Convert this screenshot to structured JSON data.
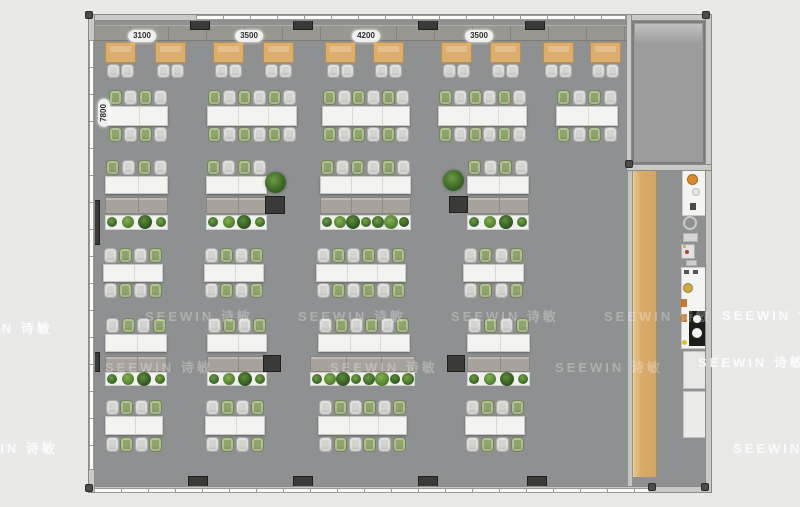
{
  "watermark": {
    "text": "SEEWIN 诗敏"
  },
  "dimension_labels": {
    "top": [
      {
        "text": "3100",
        "cx": 142,
        "cy": 36
      },
      {
        "text": "3500",
        "cx": 249,
        "cy": 36
      },
      {
        "text": "4200",
        "cx": 366,
        "cy": 36
      },
      {
        "text": "3500",
        "cx": 479,
        "cy": 36
      }
    ],
    "left": {
      "text": "7800",
      "cx": 104,
      "cy": 113
    }
  },
  "colors": {
    "background": "#e9e9e8",
    "floor": "#8f9091",
    "wood": "#d9ab6b",
    "table_white": "#f3f3f1",
    "chair_gray": "#d3d3d0",
    "chair_green": "#8ea46a",
    "credenza": "#a7a39c",
    "pillar": "#3a3a38",
    "accent_orange": "#d98a2b"
  },
  "plan": {
    "floor": {
      "x": 93,
      "y": 20,
      "w": 614,
      "h": 467
    },
    "walls": [
      {
        "name": "wall-top",
        "x": 88,
        "y": 14,
        "w": 624,
        "h": 7
      },
      {
        "name": "wall-bottom",
        "x": 88,
        "y": 486,
        "w": 624,
        "h": 7
      },
      {
        "name": "wall-left",
        "x": 88,
        "y": 14,
        "w": 7,
        "h": 479
      },
      {
        "name": "wall-right",
        "x": 705,
        "y": 14,
        "w": 7,
        "h": 479
      },
      {
        "name": "meeting-room-wall-left",
        "x": 626,
        "y": 14,
        "w": 6,
        "h": 157
      },
      {
        "name": "meeting-room-wall-bottom",
        "x": 626,
        "y": 164,
        "w": 86,
        "h": 7
      }
    ],
    "windows": [
      {
        "name": "window-strip-top",
        "dir": "h",
        "x": 196,
        "y": 15,
        "w": 430,
        "h": 5
      },
      {
        "name": "window-strip-bottom",
        "dir": "h",
        "x": 94,
        "y": 488,
        "w": 556,
        "h": 5
      },
      {
        "name": "window-strip-left",
        "dir": "v",
        "x": 89,
        "y": 40,
        "w": 5,
        "h": 430
      }
    ],
    "cabinet_band": {
      "x": 93,
      "y": 25,
      "w": 535,
      "h": 16
    },
    "meeting_room_floor": {
      "x": 632,
      "y": 21,
      "w": 73,
      "h": 143
    },
    "corridor_divider": {
      "x": 628,
      "y": 168,
      "w": 4,
      "h": 318
    },
    "wood_strip": {
      "x": 633,
      "y": 171,
      "w": 24,
      "h": 306
    },
    "pillars": [
      [
        190,
        14,
        20,
        16
      ],
      [
        293,
        14,
        20,
        16
      ],
      [
        418,
        14,
        20,
        16
      ],
      [
        525,
        14,
        20,
        16
      ],
      [
        188,
        476,
        20,
        16
      ],
      [
        293,
        476,
        20,
        16
      ],
      [
        418,
        476,
        20,
        16
      ],
      [
        527,
        476,
        20,
        16
      ],
      [
        265,
        196,
        20,
        18
      ],
      [
        449,
        196,
        19,
        17
      ],
      [
        263,
        355,
        18,
        17
      ],
      [
        447,
        355,
        18,
        17
      ],
      [
        93,
        200,
        7,
        45
      ],
      [
        93,
        352,
        7,
        20
      ]
    ],
    "corner_dots": [
      [
        85,
        11
      ],
      [
        702,
        11
      ],
      [
        85,
        484
      ],
      [
        648,
        483
      ],
      [
        701,
        483
      ],
      [
        625,
        160
      ]
    ],
    "big_plants": [
      [
        265,
        172
      ],
      [
        443,
        170
      ]
    ],
    "rows": [
      {
        "name": "window-desk-row",
        "type": "desks",
        "y": 42,
        "deskW": 31,
        "deskH": 21,
        "chairY": 64,
        "xs": [
          105,
          155,
          213,
          263,
          325,
          373,
          441,
          490,
          543,
          590
        ]
      },
      {
        "name": "bench-row-a",
        "type": "double",
        "chairTopY": 90,
        "tableY": 106,
        "tableH": 20,
        "chairBottomY": 127,
        "startGreen": true,
        "tables": [
          {
            "x": 108,
            "w": 60,
            "seats": 4
          },
          {
            "x": 207,
            "w": 90,
            "seats": 6
          },
          {
            "x": 322,
            "w": 88,
            "seats": 6
          },
          {
            "x": 438,
            "w": 89,
            "seats": 6
          },
          {
            "x": 556,
            "w": 62,
            "seats": 4
          }
        ]
      },
      {
        "name": "planter-row-a",
        "type": "planter",
        "chairTopY": 160,
        "tableY": 176,
        "tableH": 18,
        "credY": 197,
        "credH": 17,
        "plantY": 215,
        "plantH": 15,
        "startGreen": true,
        "groups": [
          {
            "x": 105,
            "w": 63,
            "seats": 4,
            "plants": 4
          },
          {
            "x": 206,
            "w": 61,
            "seats": 4,
            "plants": 4
          },
          {
            "x": 320,
            "w": 91,
            "seats": 6,
            "plants": 7
          },
          {
            "x": 467,
            "w": 62,
            "seats": 4,
            "plants": 4
          }
        ]
      },
      {
        "name": "bench-row-b",
        "type": "double",
        "chairTopY": 248,
        "tableY": 264,
        "tableH": 18,
        "chairBottomY": 283,
        "startGreen": false,
        "tables": [
          {
            "x": 103,
            "w": 60,
            "seats": 4
          },
          {
            "x": 204,
            "w": 60,
            "seats": 4
          },
          {
            "x": 316,
            "w": 90,
            "seats": 6
          },
          {
            "x": 463,
            "w": 61,
            "seats": 4
          }
        ]
      },
      {
        "name": "planter-row-b",
        "type": "planter",
        "chairTopY": 318,
        "tableY": 334,
        "tableH": 18,
        "credY": 356,
        "credH": 16,
        "plantY": 372,
        "plantH": 14,
        "startGreen": false,
        "groups": [
          {
            "x": 105,
            "w": 62,
            "seats": 4,
            "plants": 4
          },
          {
            "x": 207,
            "w": 60,
            "seats": 4,
            "plants": 4
          },
          {
            "x": 318,
            "w": 92,
            "seats": 6,
            "plants": 8,
            "credX": 310,
            "credW": 105
          },
          {
            "x": 467,
            "w": 63,
            "seats": 4,
            "plants": 4
          }
        ]
      },
      {
        "name": "bench-row-c",
        "type": "double",
        "chairTopY": 400,
        "tableY": 416,
        "tableH": 19,
        "chairBottomY": 437,
        "startGreen": false,
        "tables": [
          {
            "x": 105,
            "w": 58,
            "seats": 4
          },
          {
            "x": 205,
            "w": 60,
            "seats": 4
          },
          {
            "x": 318,
            "w": 89,
            "seats": 6
          },
          {
            "x": 465,
            "w": 60,
            "seats": 4
          }
        ]
      }
    ],
    "pantry_items": [
      {
        "t": "rect",
        "x": 682,
        "y": 170,
        "w": 25,
        "h": 46,
        "c": "#f4f4f2",
        "b": "#c9c9c7",
        "name": "pantry-counter"
      },
      {
        "t": "circ",
        "x": 687,
        "y": 174,
        "d": 11,
        "c": "#d98a2b",
        "b": "#a5641c",
        "name": "stove-burner"
      },
      {
        "t": "circ",
        "x": 692,
        "y": 188,
        "d": 8,
        "c": "#e9e9e7",
        "b": "#bbbbb9",
        "name": "sink-basin"
      },
      {
        "t": "rect",
        "x": 690,
        "y": 203,
        "w": 6,
        "h": 7,
        "c": "#4a4a48",
        "name": "fixture-glyph"
      },
      {
        "t": "ring",
        "x": 683,
        "y": 216,
        "d": 14,
        "name": "floor-fixture-ring"
      },
      {
        "t": "rect",
        "x": 683,
        "y": 233,
        "w": 15,
        "h": 9,
        "c": "#d6d6d4",
        "b": "#b5b5b3",
        "name": "floor-fixture"
      },
      {
        "t": "rect",
        "x": 681,
        "y": 244,
        "w": 14,
        "h": 15,
        "c": "#e2e2e0",
        "b": "#b0b0ae",
        "name": "appliance-panel"
      },
      {
        "t": "circ",
        "x": 685,
        "y": 250,
        "d": 4,
        "c": "#b5402f",
        "name": "panel-dot-red"
      },
      {
        "t": "circ",
        "x": 683,
        "y": 245,
        "d": 3,
        "c": "#c9a84c",
        "name": "panel-dot-gold"
      },
      {
        "t": "rect",
        "x": 686,
        "y": 260,
        "w": 11,
        "h": 6,
        "c": "#cfcfcd",
        "b": "#b0b0ae",
        "name": "floor-fixture-small"
      },
      {
        "t": "rect",
        "x": 681,
        "y": 267,
        "w": 26,
        "h": 82,
        "c": "#f4f4f2",
        "b": "#c9c9c7",
        "name": "pantry-counter"
      },
      {
        "t": "rect",
        "x": 684,
        "y": 270,
        "w": 5,
        "h": 4,
        "c": "#55554f",
        "name": "counter-glyph"
      },
      {
        "t": "rect",
        "x": 693,
        "y": 270,
        "w": 5,
        "h": 4,
        "c": "#55554f",
        "name": "counter-glyph"
      },
      {
        "t": "circ",
        "x": 683,
        "y": 283,
        "d": 10,
        "c": "#c9a84c",
        "b": "#9a7c2e",
        "name": "sink-round"
      },
      {
        "t": "rect",
        "x": 681,
        "y": 299,
        "w": 6,
        "h": 8,
        "c": "#c87830",
        "name": "counter-item-orange"
      },
      {
        "t": "rect",
        "x": 681,
        "y": 314,
        "w": 6,
        "h": 8,
        "c": "#c87830",
        "name": "counter-item-orange"
      },
      {
        "t": "rect",
        "x": 689,
        "y": 311,
        "w": 18,
        "h": 35,
        "c": "#1d1d1b",
        "name": "fridge"
      },
      {
        "t": "circ",
        "x": 693,
        "y": 315,
        "d": 8,
        "c": "#f2f2f0",
        "name": "fridge-dial"
      },
      {
        "t": "circ",
        "x": 692,
        "y": 328,
        "d": 10,
        "c": "#f2f2f0",
        "name": "fridge-dial"
      },
      {
        "t": "circ",
        "x": 682,
        "y": 340,
        "d": 5,
        "c": "#ddbf2e",
        "name": "counter-dot-yellow"
      },
      {
        "t": "rect",
        "x": 683,
        "y": 351,
        "w": 24,
        "h": 38,
        "c": "#e7e7e5",
        "b": "#c2c2c0",
        "name": "cabinet"
      },
      {
        "t": "rect",
        "x": 683,
        "y": 391,
        "w": 24,
        "h": 47,
        "c": "#ebebe9",
        "b": "#c2c2c0",
        "name": "cabinet"
      }
    ],
    "watermarks": {
      "inside": [
        [
          145,
          306
        ],
        [
          298,
          306
        ],
        [
          451,
          306
        ],
        [
          604,
          306
        ],
        [
          105,
          357
        ],
        [
          330,
          357
        ],
        [
          555,
          357
        ]
      ],
      "outside": [
        [
          -55,
          318
        ],
        [
          722,
          305
        ],
        [
          698,
          352
        ],
        [
          -50,
          438
        ],
        [
          733,
          438
        ]
      ]
    }
  }
}
